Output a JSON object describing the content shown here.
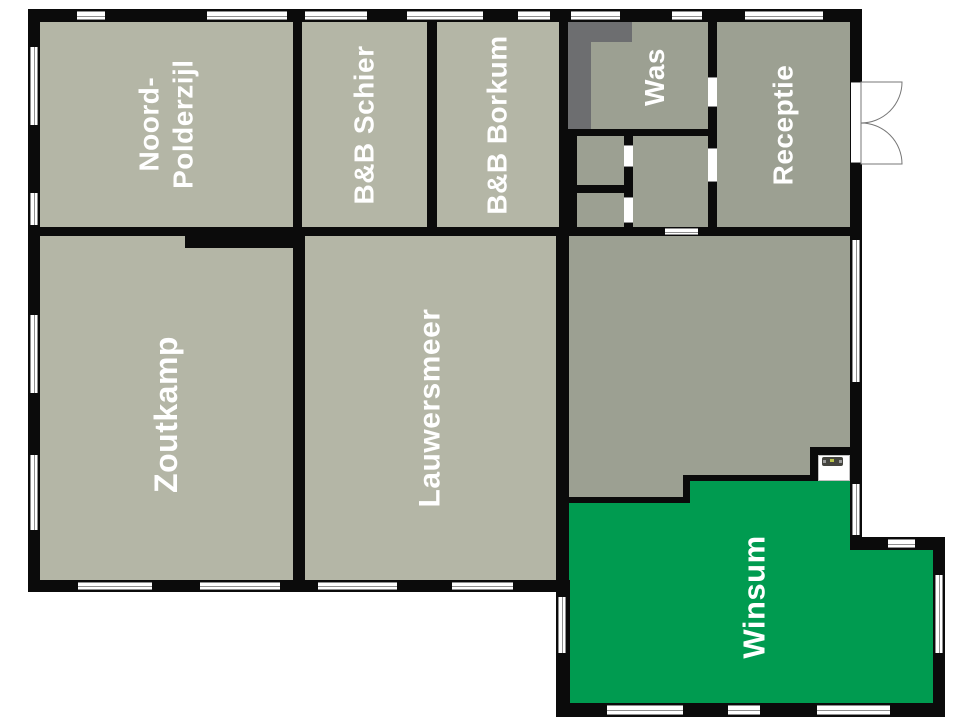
{
  "colors": {
    "background": "#ffffff",
    "wall": "#0b0b0b",
    "room_light": "#b4b6a6",
    "room_dark": "#9ca092",
    "dark_zone": "#6d6e70",
    "green": "#009b50",
    "window_frame": "#8f8f8f"
  },
  "rooms": {
    "noord_polderzijl": {
      "line1": "Noord-",
      "line2": "Polderzijl"
    },
    "bb_schier": {
      "label": "B&B Schier"
    },
    "bb_borkum": {
      "label": "B&B Borkum"
    },
    "was": {
      "label": "Was"
    },
    "receptie": {
      "label": "Receptie"
    },
    "zoutkamp": {
      "label": "Zoutkamp"
    },
    "lauwersmeer": {
      "label": "Lauwersmeer"
    },
    "winsum": {
      "label": "Winsum"
    }
  }
}
